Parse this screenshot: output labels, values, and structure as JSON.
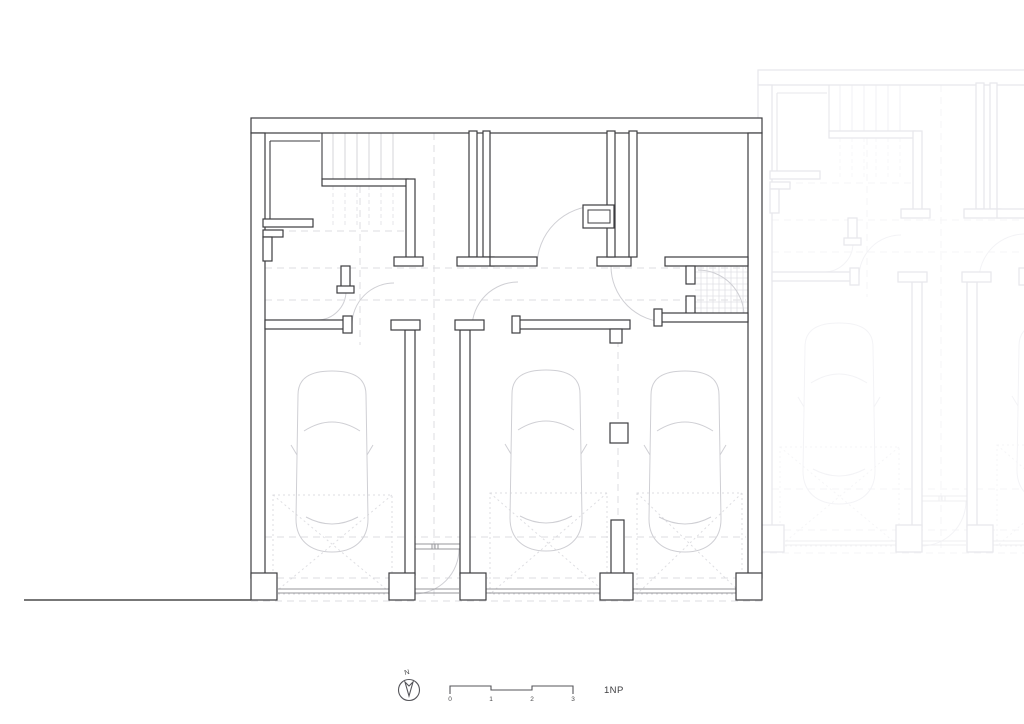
{
  "title": {
    "floor_label": "1NP"
  },
  "north_indicator": {
    "label": "N"
  },
  "scale_bar": {
    "ticks": [
      "0",
      "1",
      "2",
      "3"
    ],
    "unit_segments": 3
  },
  "plan": {
    "type": "architectural-floor-plan",
    "visible_cars_main": 3,
    "garage_openings": 4,
    "stair_flights": 1,
    "ghost_plan_position": "right"
  },
  "colors": {
    "wall": "#3d3d40",
    "light_line": "#cfcfd4",
    "dashed_line": "#dedee2",
    "ghost": "#e7e7eb",
    "door_line": "#97979b",
    "ground_line": "#4a4a4a",
    "text": "#4a4a4c",
    "background": "#ffffff"
  }
}
